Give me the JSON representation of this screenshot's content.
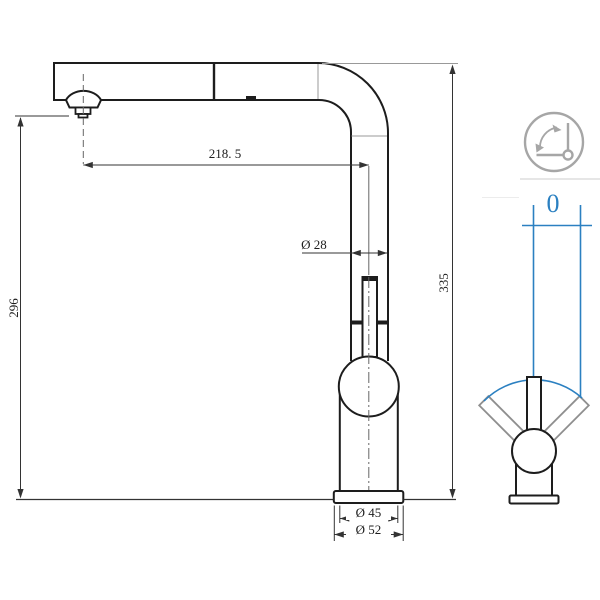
{
  "side_view": {
    "spout_reach": "218. 5",
    "spout_outlet_height": "296",
    "total_height": "335",
    "pipe_diameter": "Ø 28",
    "body_diameter": "Ø 45",
    "base_diameter": "Ø 52"
  },
  "swivel_panel": {
    "icon": "swivel-angle-icon",
    "angle_value": "0"
  },
  "colors": {
    "line_black": "#1d1d1d",
    "thin_gray": "#999999",
    "dim_gray": "#333333",
    "centerline_gray": "#666666",
    "arm_gray": "#8f8f8f",
    "accent_blue": "#2b80c1",
    "icon_gray": "#a6a6a6",
    "separator_gray": "#d8d8d8"
  }
}
